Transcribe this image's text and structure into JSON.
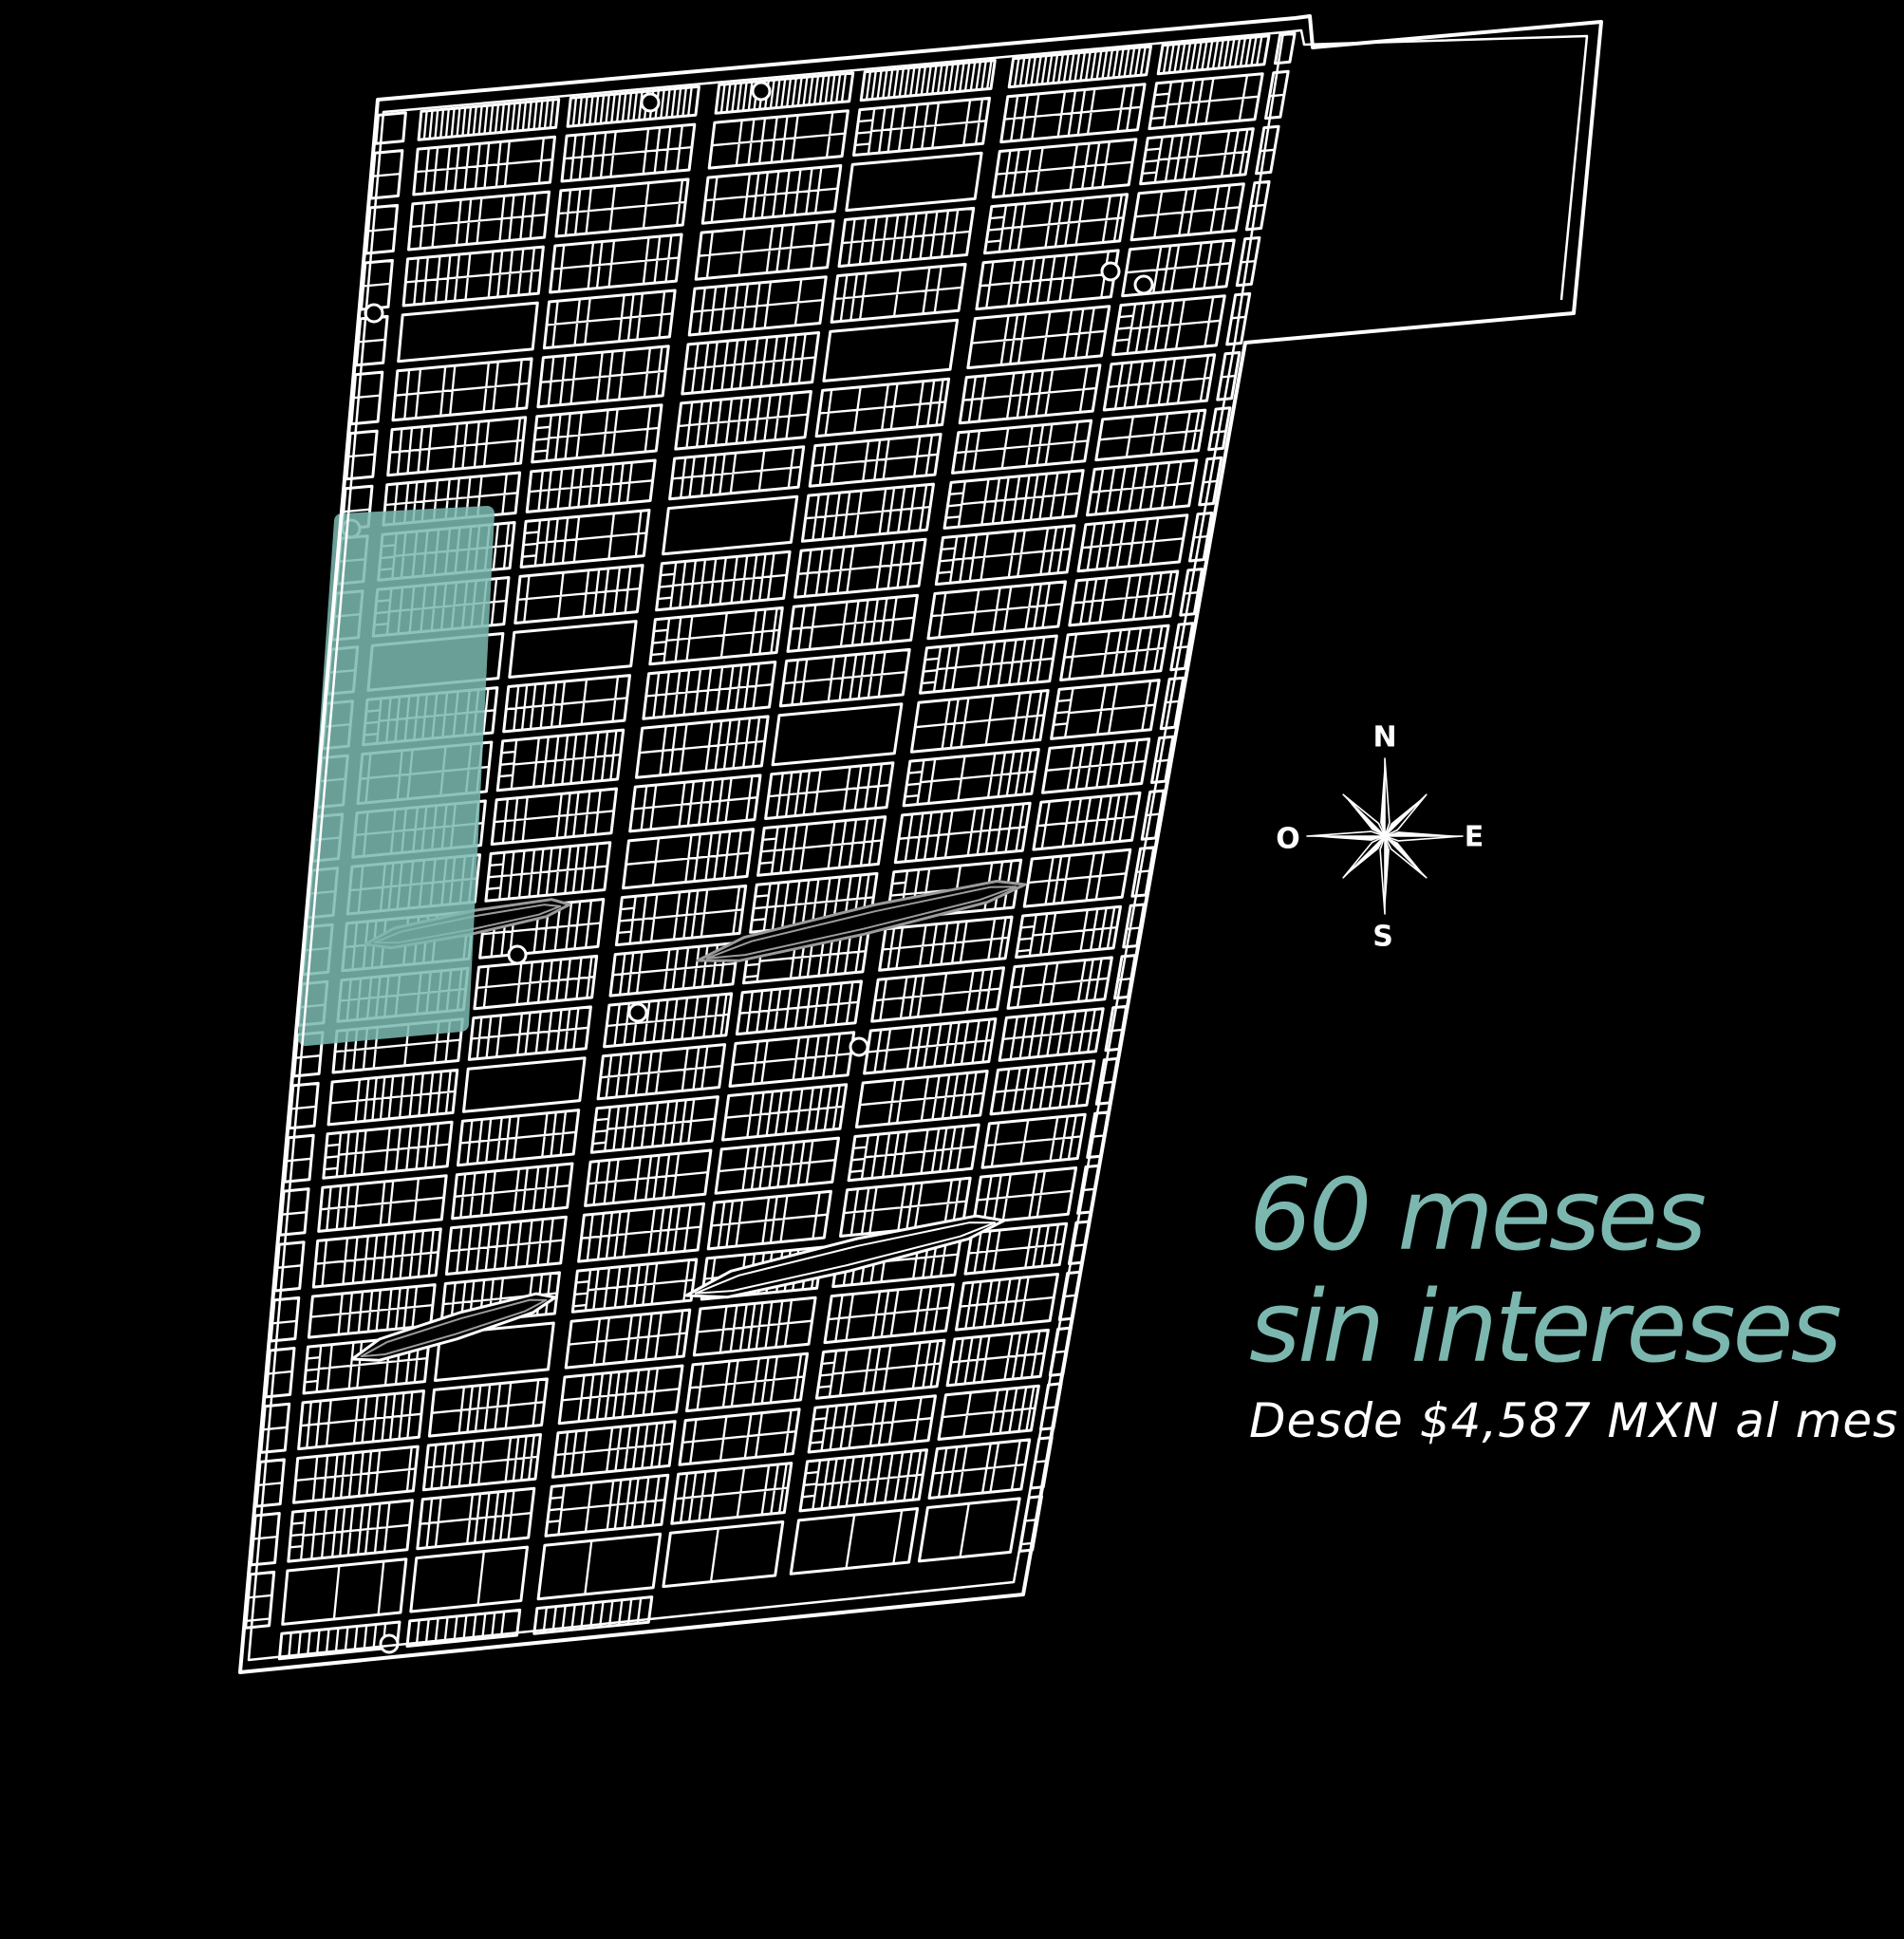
{
  "page": {
    "background": "#000000"
  },
  "promo": {
    "headline_line1": "60 meses",
    "headline_line2": "sin intereses",
    "subheadline": "Desde $4,587 MXN al mes",
    "accent_color": "#7BB7AF",
    "subheadline_color": "#FFFFFF"
  },
  "compass": {
    "labels": {
      "north": "N",
      "east": "E",
      "south": "S",
      "west": "O"
    },
    "icon": "compass-rose-icon",
    "center": [
      1459,
      881
    ],
    "radius_cardinal": 82,
    "radius_diagonal": 62,
    "radius_base": 15,
    "color": "#FFFFFF"
  },
  "map": {
    "name": "master-plan-lot-map",
    "line_color": "#FFFFFF",
    "gray_line_color": "#9B9B9B",
    "background": "#000000",
    "seed": 11,
    "quad": {
      "tl": [
        398,
        105
      ],
      "tr": [
        1365,
        19
      ],
      "br": [
        1078,
        1680
      ],
      "bl": [
        253,
        1762
      ]
    },
    "boundary": "M398,105 L1365,19 L1380,17 L1383,50 L1687,23 L1658,330 L1312,361 L1078,1680 L253,1762 Z",
    "inner_lines": [
      "M404,118 L1352,34 L1301,360 L1068,1667 L262,1749 Z",
      "M1352,34 L1371,32 L1374,47 L1672,38 L1645,316"
    ],
    "columns": [
      {
        "w": 0.03,
        "t": "strip"
      },
      {
        "w": 0.017,
        "t": "st"
      },
      {
        "w": 0.15,
        "t": "b"
      },
      {
        "w": 0.013,
        "t": "st"
      },
      {
        "w": 0.14,
        "t": "b"
      },
      {
        "w": 0.022,
        "t": "st"
      },
      {
        "w": 0.146,
        "t": "b"
      },
      {
        "w": 0.013,
        "t": "st"
      },
      {
        "w": 0.142,
        "t": "b"
      },
      {
        "w": 0.02,
        "t": "st"
      },
      {
        "w": 0.15,
        "t": "b"
      },
      {
        "w": 0.013,
        "t": "st"
      },
      {
        "w": 0.116,
        "t": "b"
      },
      {
        "w": 0.012,
        "t": "st"
      },
      {
        "w": 0.016,
        "t": "strip"
      }
    ],
    "row_plan": {
      "top": 0.01,
      "dense_h": 0.018,
      "street": 0.006,
      "block_h": 0.0285,
      "n_blocks": 26,
      "large_h": 0.034,
      "bottom_strip_h": 0.016
    },
    "lot": {
      "small_min": 0.0095,
      "small_max": 0.0135,
      "big_min": 0.024,
      "big_max": 0.04,
      "big_prob": 0.18,
      "ladder_prob": 0.22,
      "empty_prob": 0.04
    },
    "highlight": {
      "name": "available-section-highlight",
      "color": "#7CBAB2",
      "opacity": 0.86,
      "points": [
        [
          360,
          549
        ],
        [
          513,
          541
        ],
        [
          486,
          1079
        ],
        [
          322,
          1094
        ]
      ]
    },
    "lenses": [
      {
        "a": [
          735,
          1012
        ],
        "b": [
          1080,
          932
        ],
        "t": 30,
        "tone": "gray"
      },
      {
        "a": [
          385,
          995
        ],
        "b": [
          600,
          953
        ],
        "t": 26,
        "tone": "gray"
      },
      {
        "a": [
          723,
          1365
        ],
        "b": [
          1058,
          1286
        ],
        "t": 34,
        "tone": "white"
      },
      {
        "a": [
          371,
          1432
        ],
        "b": [
          585,
          1367
        ],
        "t": 28,
        "tone": "mixed"
      }
    ],
    "bulbs": [
      [
        394,
        330
      ],
      [
        370,
        557
      ],
      [
        685,
        108
      ],
      [
        802,
        96
      ],
      [
        1170,
        286
      ],
      [
        1205,
        300
      ],
      [
        672,
        1067
      ],
      [
        545,
        1006
      ],
      [
        905,
        1103
      ],
      [
        410,
        1732
      ]
    ]
  }
}
